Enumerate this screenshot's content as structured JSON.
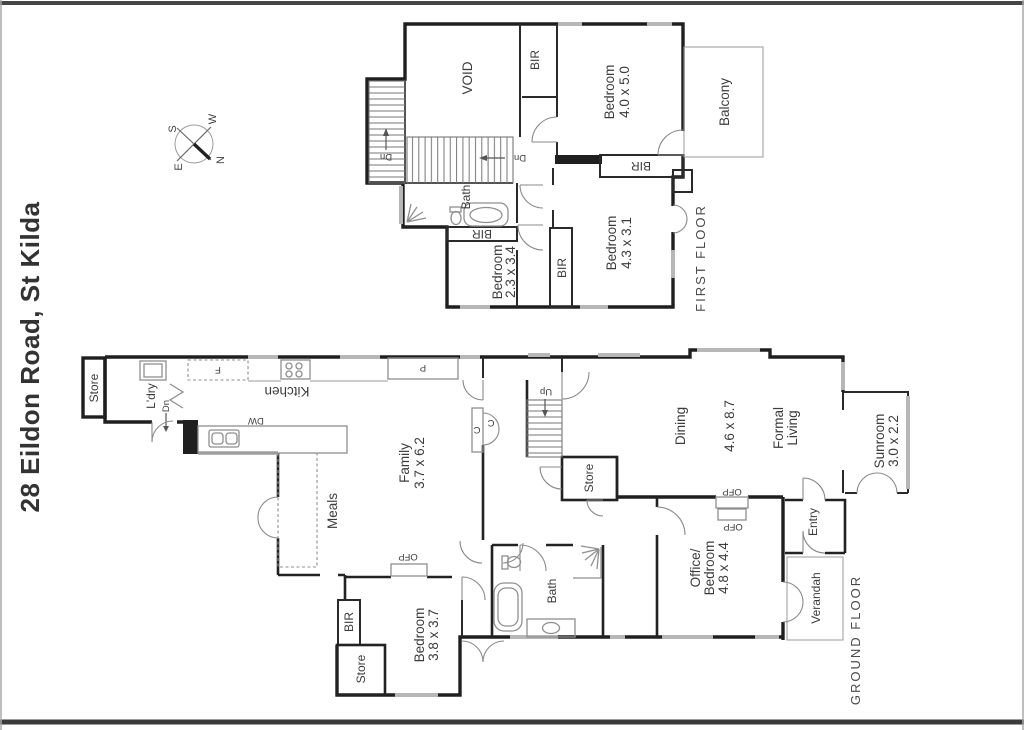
{
  "page": {
    "title": "28 Eildon Road, St Kilda"
  },
  "compass": {
    "n": "N",
    "s": "S",
    "e": "E",
    "w": "W"
  },
  "ff": {
    "label": "FIRST FLOOR",
    "void": "VOID",
    "bir_hall": "BIR",
    "bed1_name": "Bedroom",
    "bed1_dims": "4.0 x 5.0",
    "balcony": "Balcony",
    "bir_bed1": "BIR",
    "dn1": "Dn",
    "dn2": "Dn",
    "bath": "Bath",
    "bir_bath": "BIR",
    "bed2_name": "Bedroom",
    "bed2_dims": "2.3 x 3.4",
    "bir_mid": "BIR",
    "bed3_name": "Bedroom",
    "bed3_dims": "4.3 x 3.1"
  },
  "gf": {
    "label": "GROUND FLOOR",
    "store_top": "Store",
    "laundry": "L'dry",
    "dn": "Dn",
    "fridge": "F",
    "kitchen": "Kitchen",
    "dw": "DW",
    "pantry": "P",
    "family_name": "Family",
    "family_dims": "3.7 x 6.2",
    "meals": "Meals",
    "cup1": "C",
    "cup2": "C",
    "up": "Up",
    "store_stairs": "Store",
    "dining": "Dining",
    "dining_dims": "4.6 x 8.7",
    "formal1": "Formal",
    "formal2": "Living",
    "sunroom_name": "Sunroom",
    "sunroom_dims": "3.0 x 2.2",
    "ofp1": "OFP",
    "ofp2": "OFP",
    "ofp3": "OFP",
    "office1": "Office/",
    "office2": "Bedroom",
    "office_dims": "4.8 x 4.4",
    "entry": "Entry",
    "verandah": "Verandah",
    "bath": "Bath",
    "bed_name": "Bedroom",
    "bed_dims": "3.8 x 3.7",
    "bir": "BIR",
    "store_bed": "Store"
  }
}
